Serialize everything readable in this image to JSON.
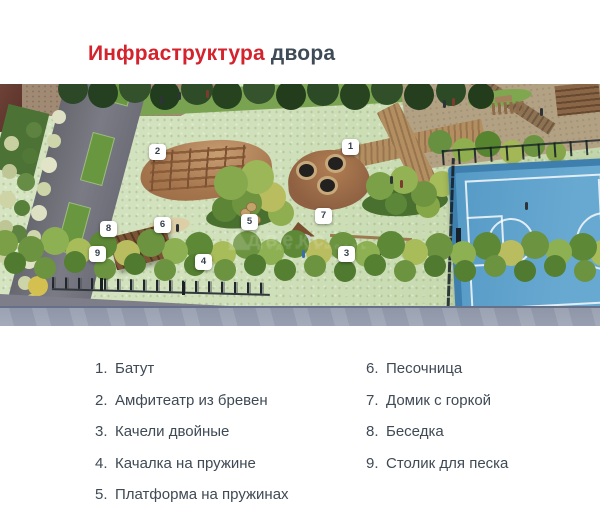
{
  "title": {
    "highlight": "Инфраструктура",
    "rest": " двора"
  },
  "scene": {
    "watermark": {
      "line1": "Адвекс",
      "line2": "недвижимость"
    },
    "markers": [
      {
        "n": "1",
        "x": 350,
        "y": 63
      },
      {
        "n": "2",
        "x": 157,
        "y": 68
      },
      {
        "n": "3",
        "x": 346,
        "y": 170
      },
      {
        "n": "4",
        "x": 203,
        "y": 178
      },
      {
        "n": "5",
        "x": 249,
        "y": 138
      },
      {
        "n": "6",
        "x": 162,
        "y": 141
      },
      {
        "n": "7",
        "x": 323,
        "y": 132
      },
      {
        "n": "8",
        "x": 108,
        "y": 145
      },
      {
        "n": "9",
        "x": 97,
        "y": 170
      }
    ]
  },
  "legend": {
    "columns": [
      {
        "items": [
          {
            "num": "1.",
            "label": "Батут"
          },
          {
            "num": "2.",
            "label": "Амфитеатр из бревен"
          },
          {
            "num": "3.",
            "label": "Качели двойные"
          },
          {
            "num": "4.",
            "label": "Качалка на пружине"
          },
          {
            "num": "5.",
            "label": "Платформа на пружинах"
          }
        ]
      },
      {
        "items": [
          {
            "num": "6.",
            "label": "Песочница"
          },
          {
            "num": "7.",
            "label": "Домик с горкой"
          },
          {
            "num": "8.",
            "label": "Беседка"
          },
          {
            "num": "9.",
            "label": "Столик для песка"
          }
        ]
      }
    ]
  },
  "colors": {
    "accent_red": "#d4232d",
    "text_dark": "#3e4a56",
    "court_blue": "#5b9cc8",
    "surface_mint": "#cfe0ba",
    "mound_brown": "#a5754e"
  }
}
